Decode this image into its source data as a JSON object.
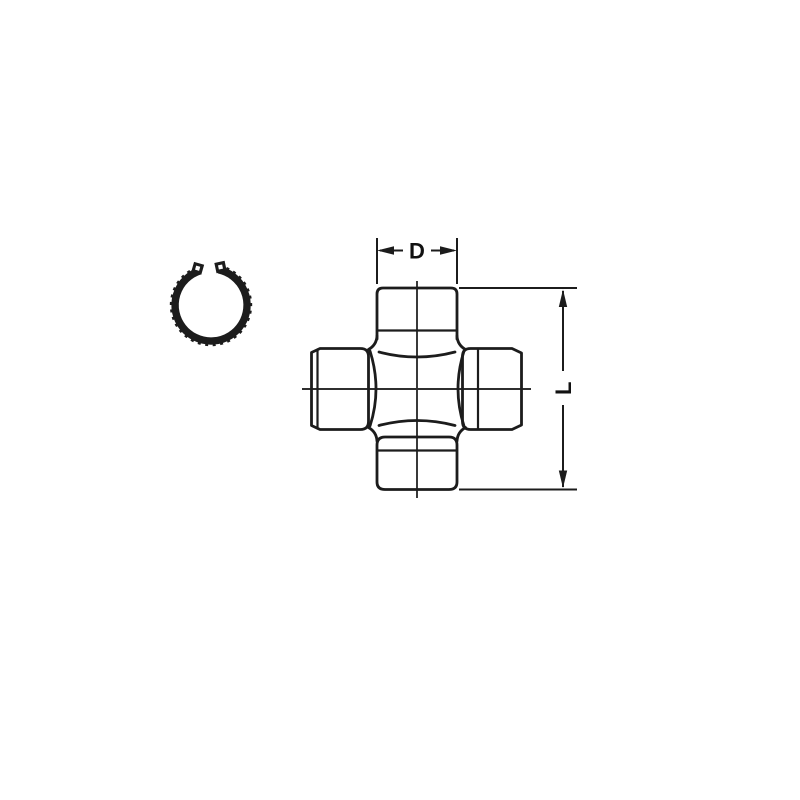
{
  "diagram": {
    "type": "technical-line-drawing",
    "subject": "universal-joint-cross-with-snap-ring",
    "labels": {
      "diameter": "D",
      "length": "L"
    },
    "colors": {
      "line": "#1c1c1c",
      "background": "#ffffff"
    },
    "icons": [
      "snap-ring-icon",
      "u-joint-cross-drawing"
    ]
  }
}
